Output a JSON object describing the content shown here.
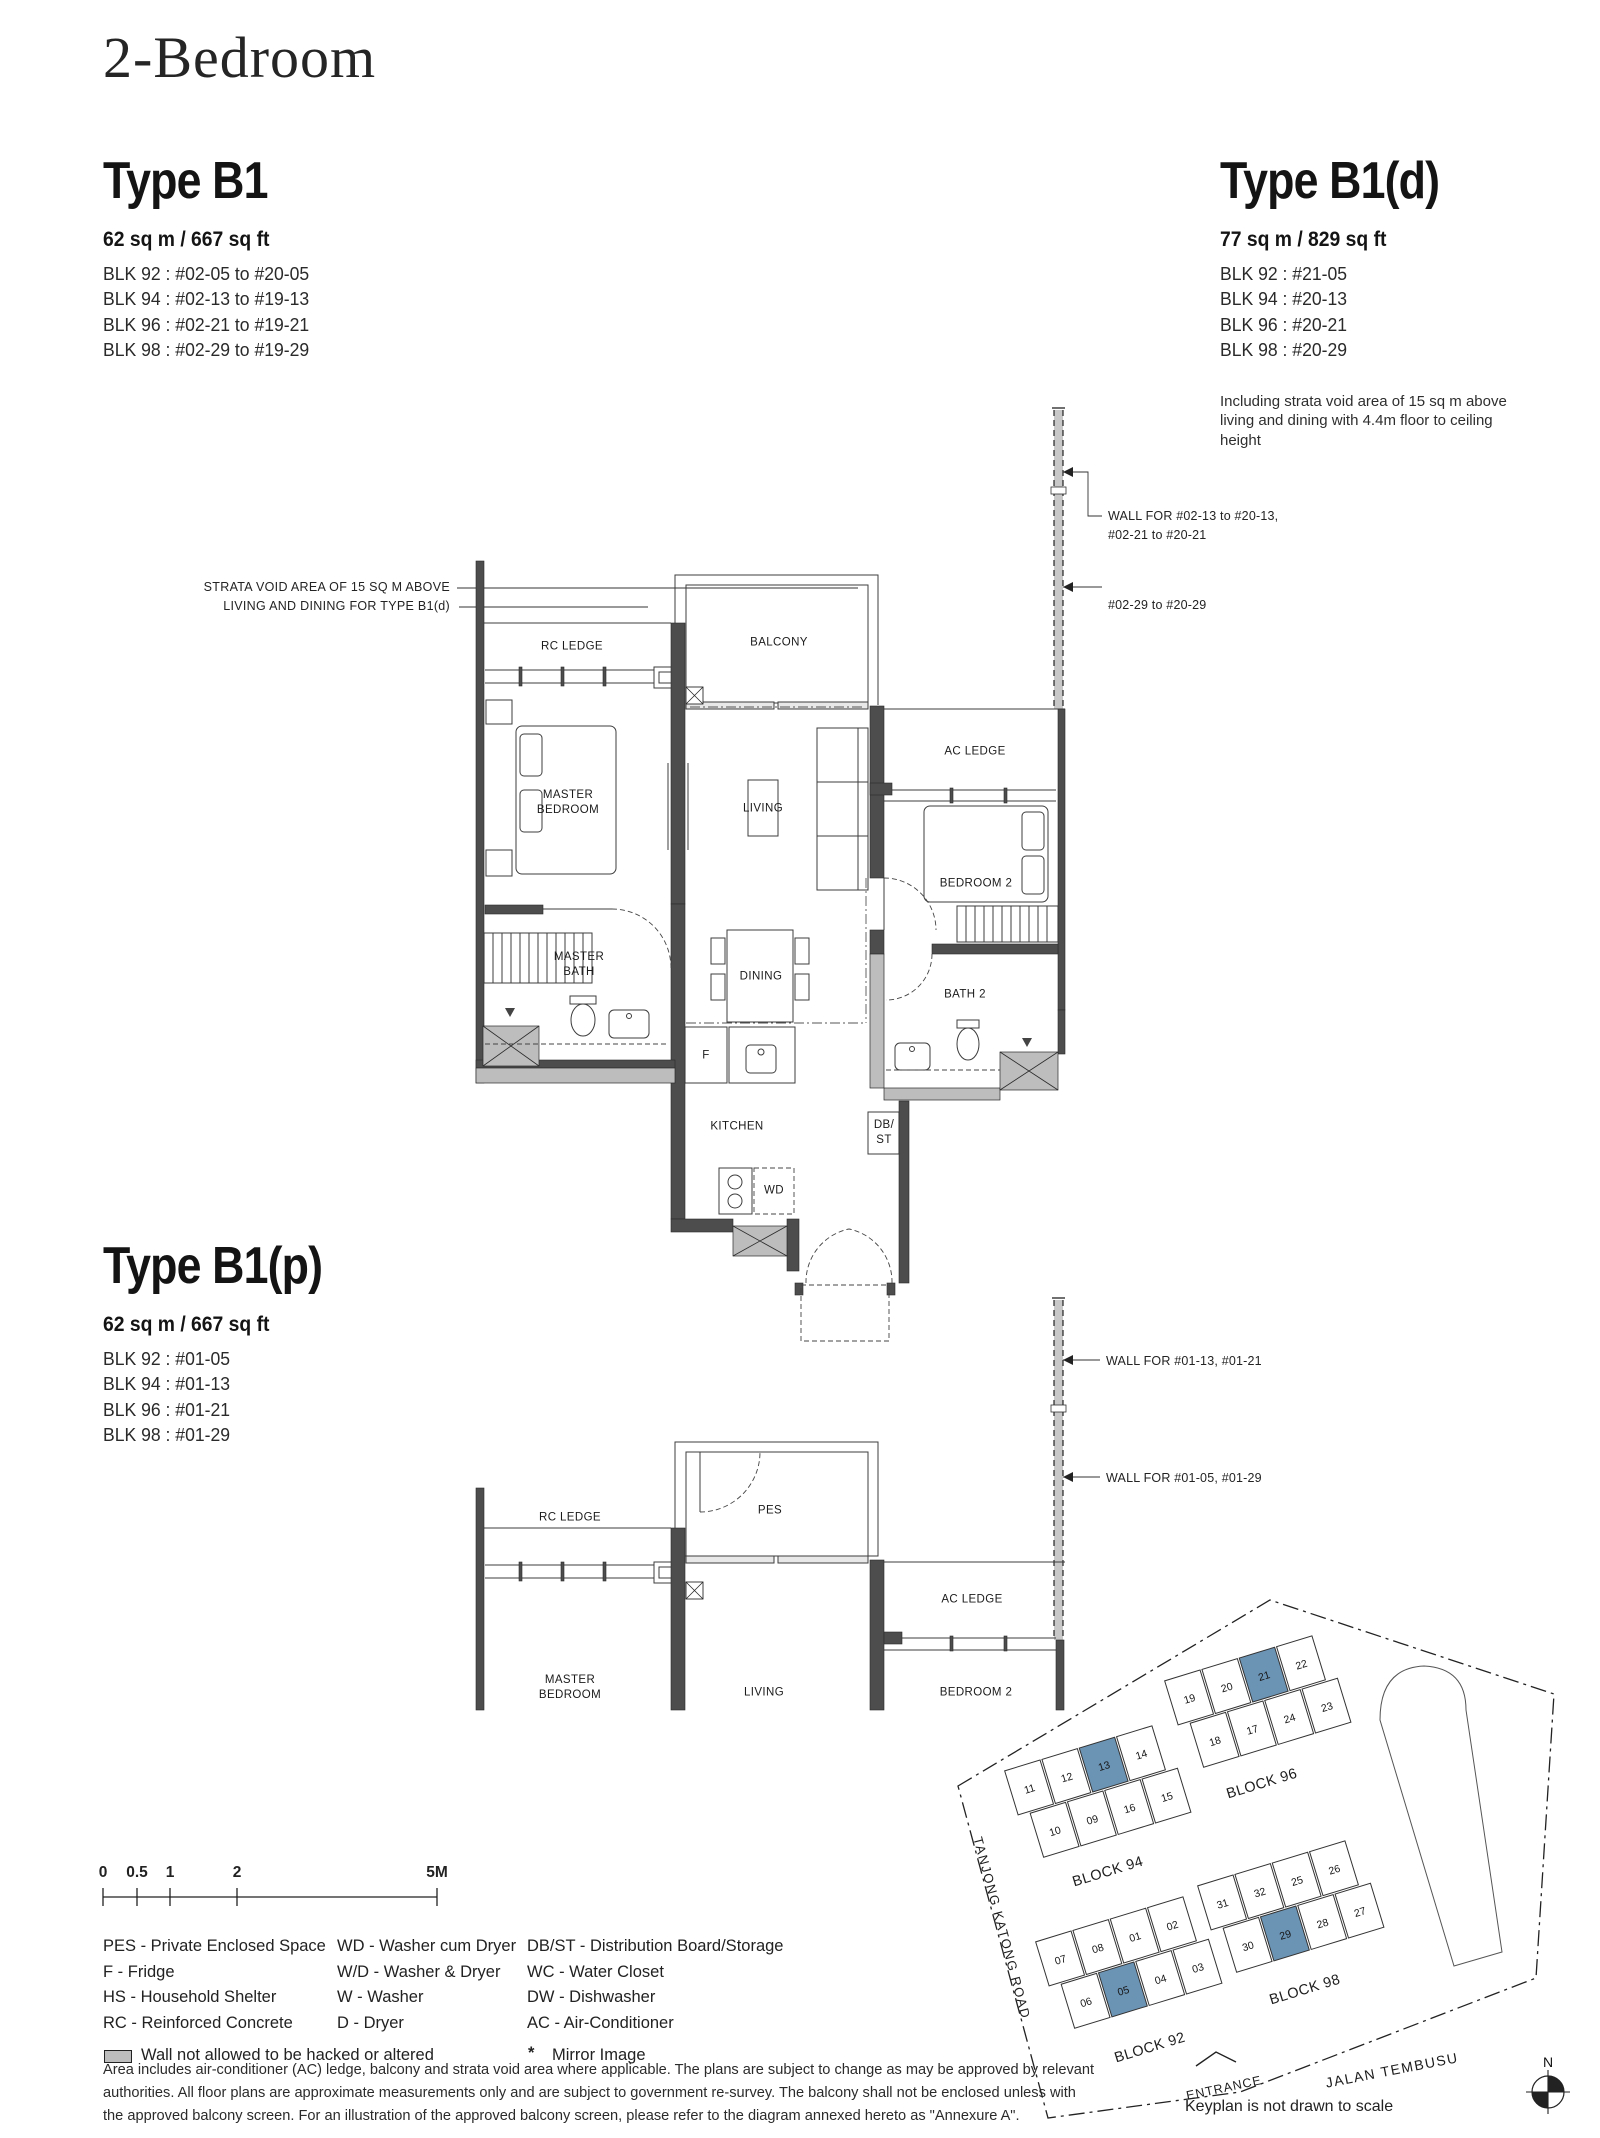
{
  "page_title": "2-Bedroom",
  "types": {
    "b1": {
      "title": "Type B1",
      "area": "62 sq m / 667 sq ft",
      "blocks": [
        "BLK 92 : #02-05 to #20-05",
        "BLK 94 : #02-13 to #19-13",
        "BLK 96 : #02-21 to #19-21",
        "BLK 98 : #02-29 to #19-29"
      ]
    },
    "b1d": {
      "title": "Type B1(d)",
      "area": "77 sq m / 829 sq ft",
      "blocks": [
        "BLK 92 : #21-05",
        "BLK 94 : #20-13",
        "BLK 96 : #20-21",
        "BLK 98 : #20-29"
      ],
      "note": "Including strata void area of 15 sq m above living and dining with 4.4m floor to ceiling height"
    },
    "b1p": {
      "title": "Type B1(p)",
      "area": "62 sq m / 667 sq ft",
      "blocks": [
        "BLK 92 : #01-05",
        "BLK 94 : #01-13",
        "BLK 96 : #01-21",
        "BLK 98 : #01-29"
      ]
    }
  },
  "plan_upper": {
    "strata_note": "STRATA VOID AREA OF 15 SQ M ABOVE\nLIVING AND DINING FOR TYPE  B1(d)",
    "wall_note_1": "WALL FOR #02-13 to #20-13,\n#02-21 to #20-21",
    "wall_note_2": "#02-29 to #20-29",
    "labels": {
      "rc_ledge": "RC LEDGE",
      "balcony": "BALCONY",
      "master_bedroom": "MASTER\nBEDROOM",
      "living": "LIVING",
      "ac_ledge": "AC LEDGE",
      "bedroom_2": "BEDROOM 2",
      "master_bath": "MASTER\nBATH",
      "dining": "DINING",
      "bath_2": "BATH 2",
      "fridge": "F",
      "kitchen": "KITCHEN",
      "db_st": "DB/\nST",
      "wd": "WD"
    }
  },
  "plan_lower": {
    "wall_note_1": "WALL FOR #01-13, #01-21",
    "wall_note_2": "WALL FOR #01-05, #01-29",
    "labels": {
      "rc_ledge": "RC LEDGE",
      "pes": "PES",
      "ac_ledge": "AC LEDGE",
      "master_bedroom": "MASTER\nBEDROOM",
      "living": "LIVING",
      "bedroom_2": "BEDROOM 2"
    }
  },
  "scale_bar": {
    "labels": [
      "0",
      "0.5",
      "1",
      "2",
      "5M"
    ]
  },
  "legend": {
    "col1": [
      "PES - Private Enclosed Space",
      "F - Fridge",
      "HS - Household Shelter",
      "RC - Reinforced Concrete"
    ],
    "col2": [
      "WD - Washer cum Dryer",
      "W/D - Washer & Dryer",
      "W - Washer",
      "D - Dryer"
    ],
    "col3": [
      "DB/ST - Distribution Board/Storage",
      "WC - Water Closet",
      "DW - Dishwasher",
      "AC - Air-Conditioner"
    ],
    "wall_note": "Wall not allowed to be hacked or altered",
    "mirror_symbol": "*",
    "mirror_note": "Mirror Image"
  },
  "disclaimer": [
    "Area includes air-conditioner (AC) ledge, balcony and strata void area where applicable. The plans are subject to change as may be approved by relevant",
    "authorities. All floor plans are approximate measurements only and are subject to government re-survey. The balcony shall not be enclosed unless with",
    "the approved balcony screen. For an illustration of the approved balcony screen, please refer to the diagram annexed hereto as \"Annexure A\"."
  ],
  "keyplan": {
    "blocks": [
      {
        "name": "BLOCK 94",
        "top": [
          "11",
          "12",
          "13",
          "14"
        ],
        "bottom": [
          "10",
          "09",
          "16",
          "15"
        ],
        "highlight": "13"
      },
      {
        "name": "BLOCK 96",
        "top": [
          "19",
          "20",
          "21",
          "22"
        ],
        "bottom": [
          "18",
          "17",
          "24",
          "23"
        ],
        "highlight": "21"
      },
      {
        "name": "BLOCK 98",
        "top": [
          "31",
          "32",
          "25",
          "26"
        ],
        "bottom": [
          "30",
          "29",
          "28",
          "27"
        ],
        "highlight": "29"
      },
      {
        "name": "BLOCK 92",
        "top": [
          "07",
          "08",
          "01",
          "02"
        ],
        "bottom": [
          "06",
          "05",
          "04",
          "03"
        ],
        "highlight": "05"
      }
    ],
    "road_left": "TANJONG KATONG ROAD",
    "road_bottom": "JALAN TEMBUSU",
    "entrance": "ENTRANCE",
    "note": "Keyplan is not drawn to scale",
    "compass_label": "N",
    "highlight_color": "#6b93b4"
  },
  "colors": {
    "wall_dark": "#4d4d4d",
    "wall_gray": "#bdbdbd",
    "dashed_wall": "#c8c8c8",
    "text": "#1d1d1d"
  }
}
